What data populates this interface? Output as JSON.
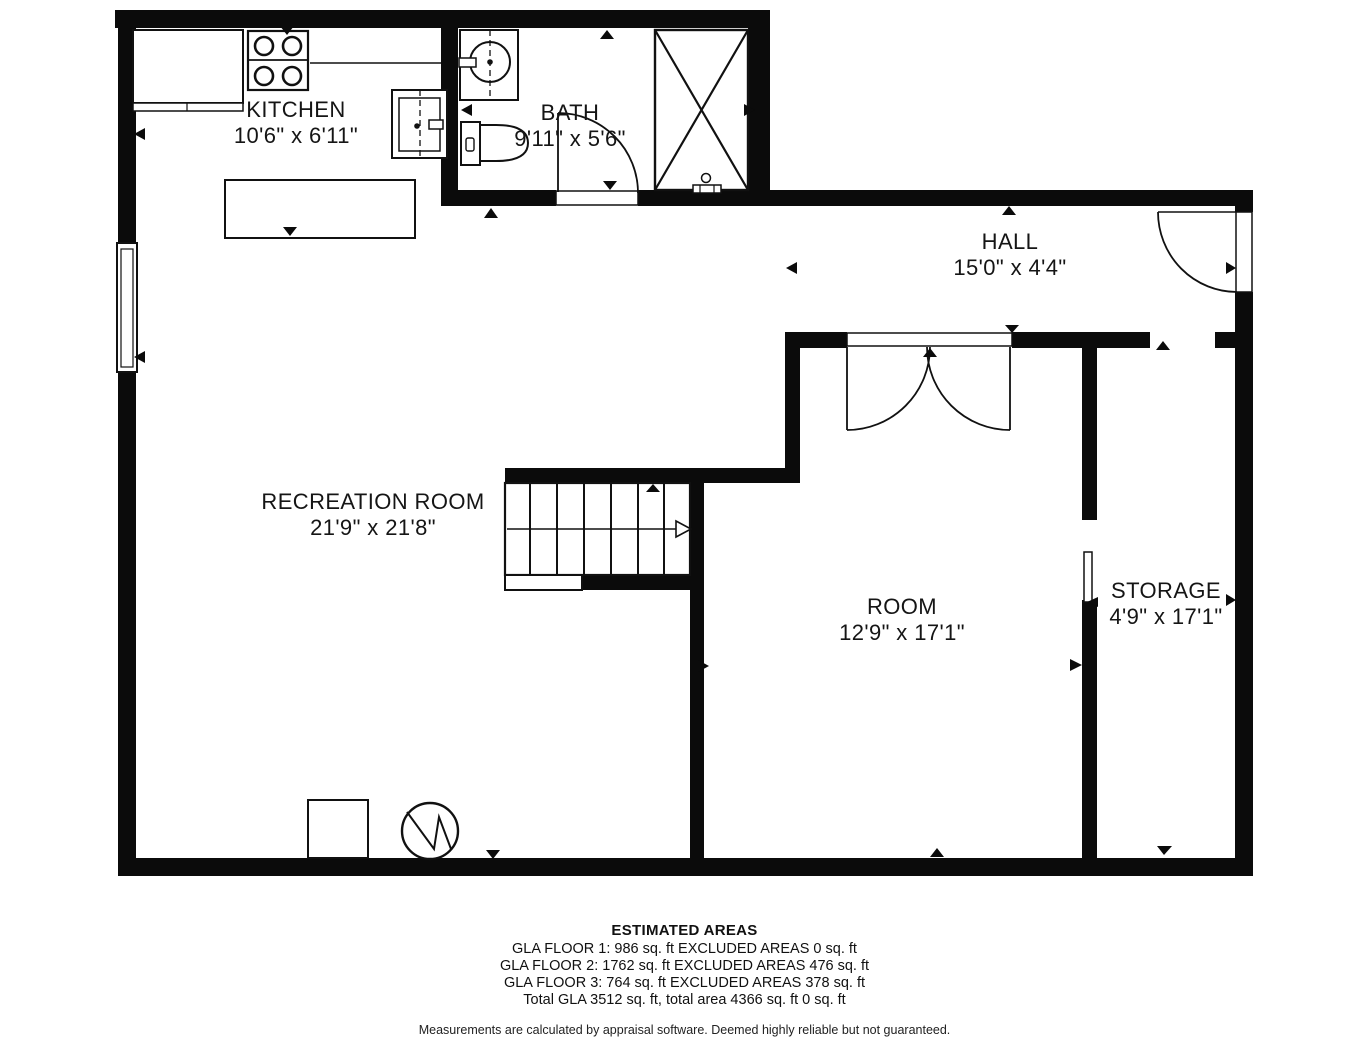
{
  "rooms": [
    {
      "name": "KITCHEN",
      "dims": "10'6\" x 6'11\""
    },
    {
      "name": "BATH",
      "dims": "9'11\" x 5'6\""
    },
    {
      "name": "HALL",
      "dims": "15'0\" x 4'4\""
    },
    {
      "name": "RECREATION ROOM",
      "dims": "21'9\" x 21'8\""
    },
    {
      "name": "ROOM",
      "dims": "12'9\" x 17'1\""
    },
    {
      "name": "STORAGE",
      "dims": "4'9\" x 17'1\""
    }
  ],
  "estimated_areas": {
    "title": "ESTIMATED AREAS",
    "lines": [
      "GLA FLOOR 1: 986 sq. ft EXCLUDED AREAS 0 sq. ft",
      "GLA FLOOR 2: 1762 sq. ft EXCLUDED AREAS 476 sq. ft",
      "GLA FLOOR 3: 764 sq. ft EXCLUDED AREAS 378 sq. ft",
      "Total GLA 3512 sq. ft, total area 4366 sq. ft 0 sq. ft"
    ],
    "disclaimer": "Measurements are calculated by appraisal software. Deemed highly reliable but not guaranteed."
  },
  "colors": {
    "wall": "#0b0b0b",
    "background": "#ffffff"
  }
}
